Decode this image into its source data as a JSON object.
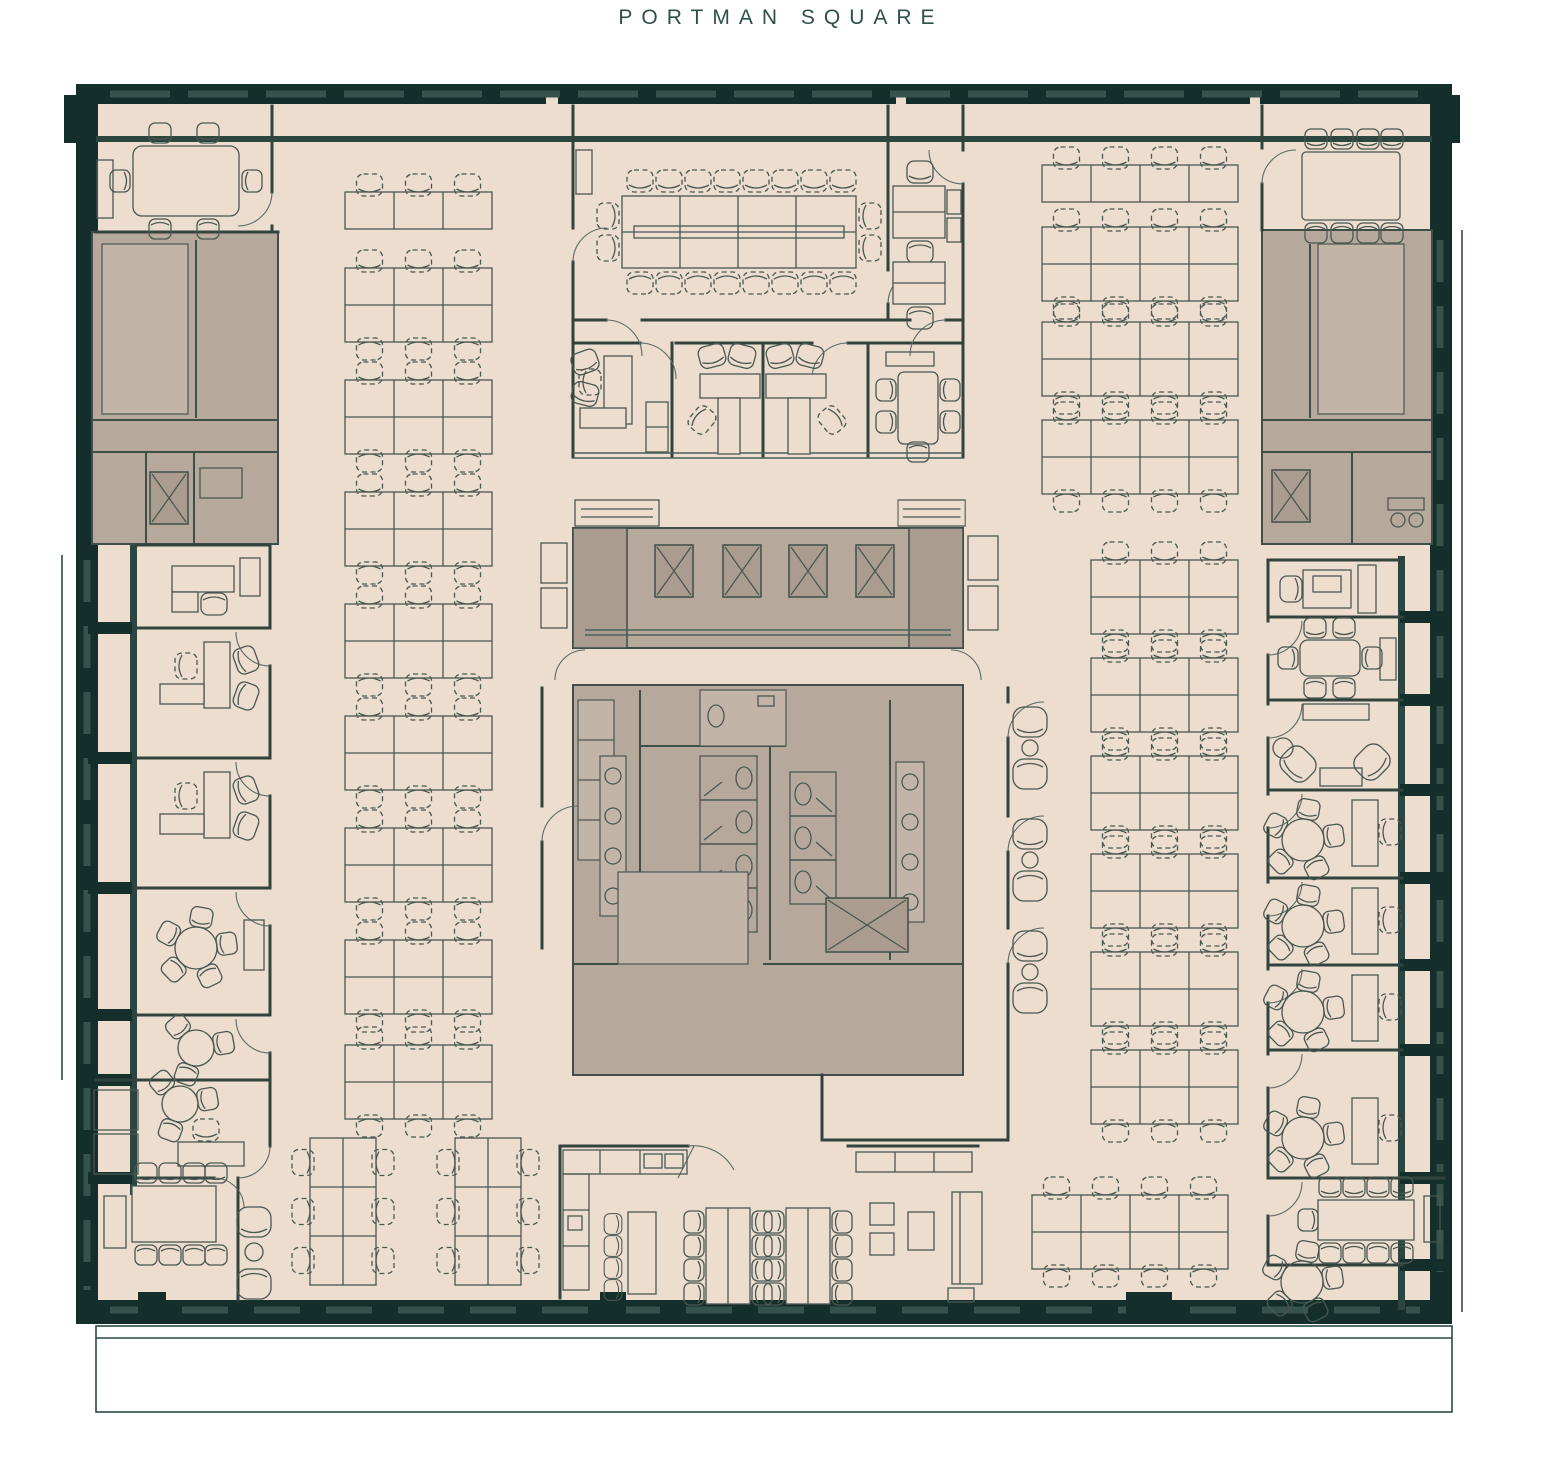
{
  "title": "PORTMAN SQUARE",
  "colors": {
    "wall": "#142f2b",
    "floor": "#ecddcf",
    "core": "#b6a99c",
    "furniture_line": "#4a5751",
    "title_text": "#2d5149",
    "terrace_line": "#2a4a44"
  },
  "rooms": [
    {
      "id": "meeting-room-top-left",
      "type": "meeting room",
      "seats": 6
    },
    {
      "id": "boardroom-top-centre",
      "type": "boardroom",
      "seats": 20
    },
    {
      "id": "office-right-of-boardroom",
      "type": "private office",
      "desks": 2
    },
    {
      "id": "meeting-room-top-right",
      "type": "meeting room",
      "seats": 8
    },
    {
      "id": "office-mid-left",
      "type": "private office",
      "seats": 3
    },
    {
      "id": "offices-mid-centre",
      "type": "paired offices",
      "desks": 2,
      "guest_seats": 4
    },
    {
      "id": "meeting-room-mid-right",
      "type": "meeting room",
      "seats": 5
    },
    {
      "id": "left-office-column",
      "type": "private offices",
      "count": 5
    },
    {
      "id": "right-office-column",
      "type": "private offices",
      "count": 6
    },
    {
      "id": "meeting-room-bottom-left",
      "type": "meeting room",
      "seats": 8
    },
    {
      "id": "meeting-room-bottom-right",
      "type": "meeting room",
      "seats": 9
    },
    {
      "id": "cafe-kitchen",
      "type": "cafe / tea point",
      "table_seats": 16,
      "bench_stools": 4
    },
    {
      "id": "lounge-bottom-centre",
      "type": "lounge",
      "seats": 4
    },
    {
      "id": "phone-seating-core-east",
      "type": "armchair pairs",
      "seats": 6
    }
  ],
  "open_plan": {
    "left_block_desks": 51,
    "right_block_desks": 76,
    "bottom_cluster_desks": 12
  },
  "core": {
    "main_lift_bank": 4,
    "other_lifts": 3,
    "staircases": 3,
    "wc_stalls": 8,
    "accessible_wc": 1,
    "basins": 8
  }
}
